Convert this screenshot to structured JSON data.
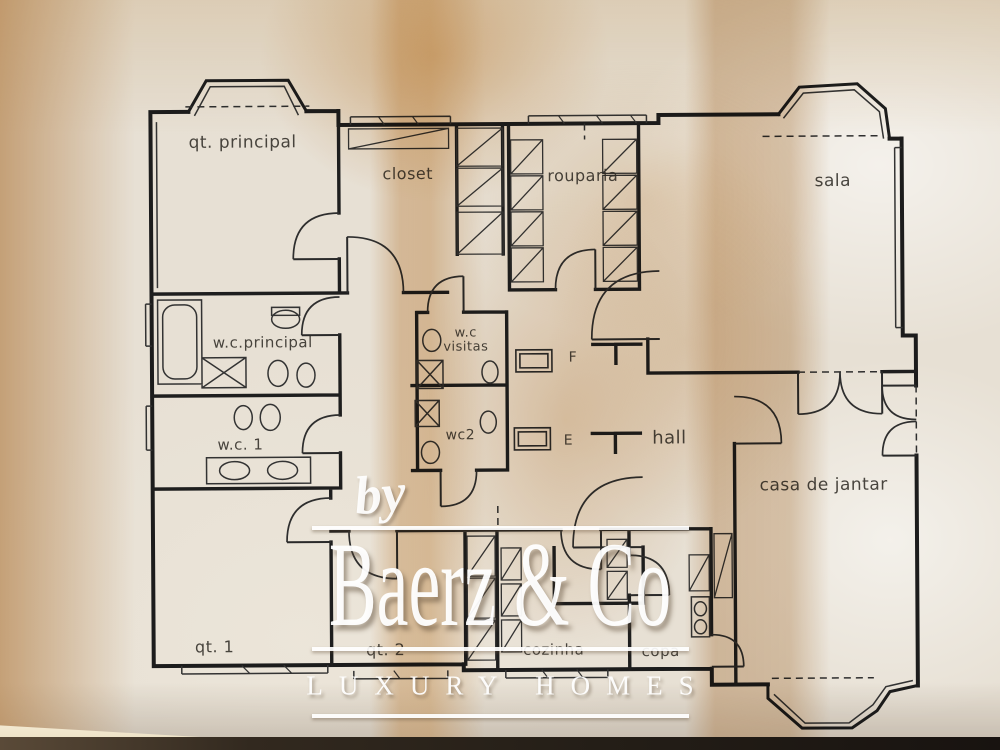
{
  "plan": {
    "rooms": [
      {
        "id": "qt-principal",
        "label": "qt. principal",
        "x": 244,
        "y": 141,
        "size": 17
      },
      {
        "id": "closet",
        "label": "closet",
        "x": 409,
        "y": 173,
        "size": 16
      },
      {
        "id": "rouparia",
        "label": "rouparia",
        "x": 584,
        "y": 176,
        "size": 16
      },
      {
        "id": "sala",
        "label": "sala",
        "x": 834,
        "y": 183,
        "size": 17
      },
      {
        "id": "wc-principal",
        "label": "w.c.principal",
        "x": 263,
        "y": 341,
        "size": 15
      },
      {
        "id": "wc-visitas",
        "label": "w.c visitas",
        "x": 466,
        "y": 340,
        "size": 13,
        "w": 54
      },
      {
        "id": "wc-1",
        "label": "w.c. 1",
        "x": 240,
        "y": 443,
        "size": 15
      },
      {
        "id": "wc-2",
        "label": "wc2",
        "x": 460,
        "y": 435,
        "size": 14
      },
      {
        "id": "marker-f",
        "label": "F",
        "x": 573,
        "y": 358,
        "size": 14
      },
      {
        "id": "marker-e",
        "label": "E",
        "x": 568,
        "y": 441,
        "size": 14
      },
      {
        "id": "hall",
        "label": "hall",
        "x": 669,
        "y": 439,
        "size": 18
      },
      {
        "id": "casa-de-jantar",
        "label": "casa de jantar",
        "x": 823,
        "y": 487,
        "size": 17
      },
      {
        "id": "qt-1",
        "label": "qt. 1",
        "x": 213,
        "y": 645,
        "size": 16
      },
      {
        "id": "qt-2",
        "label": "qt. 2",
        "x": 384,
        "y": 649,
        "size": 16
      },
      {
        "id": "cozinha",
        "label": "cozinha",
        "x": 552,
        "y": 650,
        "size": 15
      },
      {
        "id": "copa",
        "label": "copa",
        "x": 659,
        "y": 652,
        "size": 15
      }
    ]
  },
  "watermark": {
    "prefix": "by",
    "brand": "Baerz & Co",
    "tagline": "LUXURY HOMES"
  }
}
